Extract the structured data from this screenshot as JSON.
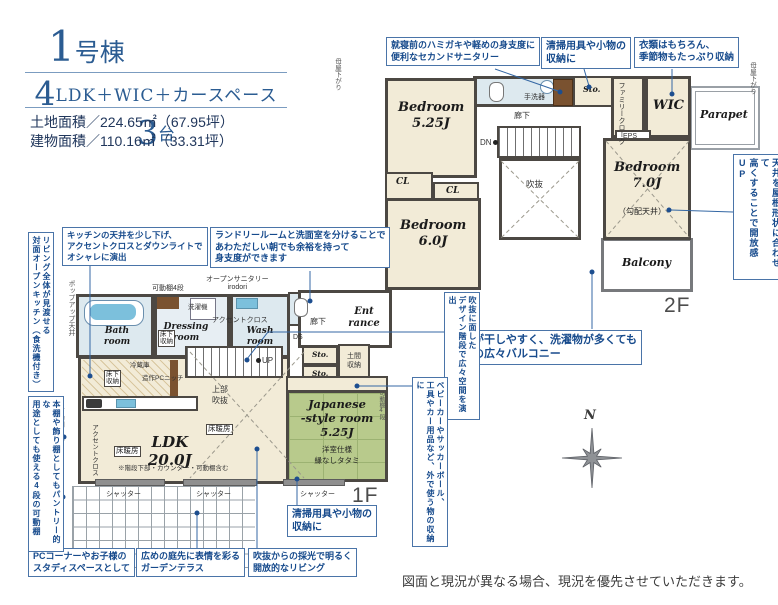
{
  "header": {
    "building_num": "1",
    "building_unit": "号棟",
    "plan_num1": "4",
    "plan_mid": "LDK＋WIC＋カースペース",
    "plan_num2": "3",
    "plan_unit": "台",
    "land_area": "土地面積／224.65㎡（67.95坪）",
    "building_area": "建物面積／110.16㎡（33.31坪）"
  },
  "notes": {
    "second_sanitary": [
      "就寝前のハミガキや軽めの身支度に",
      "便利なセカンドサニタリー"
    ],
    "cleaning_2f": [
      "清掃用具や小物の",
      "収納に"
    ],
    "wic": [
      "衣類はもちろん、",
      "季節物もたっぷり収納"
    ],
    "kitchen_ceiling": [
      "キッチンの天井を少し下げ、",
      "アクセントクロスとダウンライトで",
      "オシャレに演出"
    ],
    "laundry": [
      "ランドリールームと洗面室を分けることで",
      "あわただしい朝でも余裕を持って",
      "身支度ができます"
    ],
    "balcony": [
      "布団が干しやすく、洗濯物が多くても",
      "安心の広々バルコニー"
    ],
    "cleaning_1f": [
      "清掃用具や小物の",
      "収納に"
    ],
    "pc_corner": [
      "PCコーナーやお子様の",
      "スタディスペースとして"
    ],
    "garden_terrace": [
      "広めの庭先に表情を彩る",
      "ガーデンテラス"
    ],
    "bright_living": [
      "吹抜からの採光で明るく",
      "開放的なリビング"
    ],
    "open_kitchen": [
      "リビング全体が見渡せる",
      "対面オープンキッチン（食洗機付き）"
    ],
    "movable_shelf": [
      "本棚や飾り棚としてもパントリー的な",
      "用途としても使える4段の可動棚"
    ],
    "design_stairs": [
      "吹抜に面した",
      "デザイン階段で広々空間を演出"
    ],
    "outdoor_storage": [
      "ベビーカーやサッカーボール、",
      "工具やカー用品など、外で使う物の収納に"
    ],
    "high_ceiling": [
      "天井を屋根形状に合わせて",
      "高くすることで開放感UP"
    ]
  },
  "floor2": {
    "label": "2F",
    "bedroom1": [
      "Bedroom",
      "5.25J"
    ],
    "bedroom2": [
      "Bedroom",
      "6.0J"
    ],
    "bedroom3": [
      "Bedroom",
      "7.0J"
    ],
    "sloped_ceiling": "（勾配天井）",
    "cl1": "CL",
    "cl2": "CL",
    "wic": "WIC",
    "family_closet": "ファミリークローク",
    "sto": "Sto.",
    "counter": "カウンター",
    "hand_basin": "手洗器",
    "corridor": "廊下",
    "dn": "DN",
    "void": "吹抜",
    "eps": "EPS",
    "parapet": "Parapet",
    "balcony": "Balcony",
    "moya_left": "母屋下がり",
    "moya_right": "母屋下がり"
  },
  "floor1": {
    "label": "1F",
    "bath": [
      "Bath",
      "room"
    ],
    "dressing": [
      "Dressing",
      "room"
    ],
    "wash": [
      "Wash",
      "room"
    ],
    "washer": "洗濯機",
    "shelf_top": "可動棚4段",
    "open_sanitary": [
      "オープンサニタリー",
      "irodori"
    ],
    "accent_wash": "アクセントクロス",
    "popup_ceiling": "ポップアップ天井",
    "underfloor_dressing": [
      "床下",
      "収納"
    ],
    "underfloor_kitchen": [
      "床下",
      "収納"
    ],
    "fridge": "冷蔵庫",
    "pc_niche": "造作PCニッチ",
    "corridor": "廊下",
    "entrance": [
      "Ent",
      "rance"
    ],
    "ds": "DS",
    "sto1": "Sto.",
    "sto2": "Sto.",
    "doma": [
      "土間",
      "収納"
    ],
    "up": "UP",
    "upper_void": [
      "上部",
      "吹抜"
    ],
    "ldk": [
      "LDK",
      "20.0J"
    ],
    "floor_heating": "床暖房",
    "ldk_note": "※階段下部・カウンター・可動棚含む",
    "accent_ldk": "アクセントクロス",
    "pantry_shelf": "可動棚4段",
    "counter_open": [
      "カウンター",
      "（下部開放）"
    ],
    "japanese": [
      "Japanese",
      "-style room",
      "5.25J"
    ],
    "japanese_spec": [
      "洋室仕様",
      "縁なしタタミ"
    ],
    "shelf_right": "可動棚4段",
    "shutter": "シャッター"
  },
  "compass": {
    "north": "N"
  },
  "footer": {
    "disclaimer": "図面と現況が異なる場合、現況を優先させていただきます。"
  },
  "colors": {
    "annotation_text": "#164a8c",
    "annotation_border": "#4a74a8",
    "title_blue": "#2b5c92",
    "wall_gray": "#4c4843",
    "room_cream": "#f2ebd7",
    "sanitary_blue": "#dde9ef",
    "tatami_green": "#b8ca8c",
    "water_blue": "#7cc0dc",
    "wood_brown": "#7a5230"
  }
}
